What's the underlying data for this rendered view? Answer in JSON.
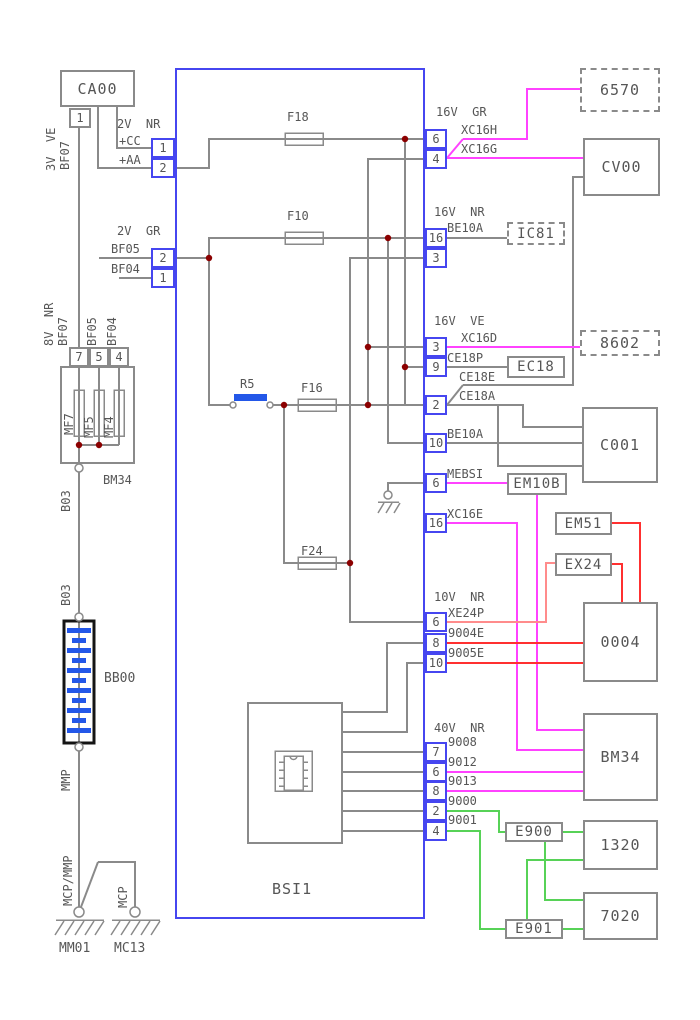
{
  "unit": {
    "name": "BSI1"
  },
  "components": {
    "ca00": "CA00",
    "fusebox": "BM34",
    "battery": "BB00",
    "ground_left": "MM01",
    "ground_right": "MC13",
    "b6570": "6570",
    "cv00": "CV00",
    "ic81": "IC81",
    "b8602": "8602",
    "ec18": "EC18",
    "c001": "C001",
    "em10b": "EM10B",
    "em51": "EM51",
    "ex24": "EX24",
    "b0004": "0004",
    "bm34": "BM34",
    "e900": "E900",
    "b1320": "1320",
    "e901": "E901",
    "b7020": "7020"
  },
  "fuses": {
    "f18": "F18",
    "f10": "F10",
    "f16": "F16",
    "f24": "F24",
    "mf7": "MF7",
    "mf5": "MF5",
    "mf4": "MF4",
    "r5": "R5"
  },
  "wires": {
    "v3ve": "3V  VE",
    "bf07_top": "BF07",
    "v2nr": "2V  NR",
    "cc": "+CC",
    "aa": "+AA",
    "v2gr": "2V  GR",
    "bf05": "BF05",
    "bf04": "BF04",
    "v8nr": "8V  NR",
    "bf07": "BF07",
    "bf05v": "BF05",
    "bf04v": "BF04",
    "b03_a": "B03",
    "b03_b": "B03",
    "mmp": "MMP",
    "mcp_mmp": "MCP/MMP",
    "mcp": "MCP",
    "g16vgr": "16V  GR",
    "xc16h": "XC16H",
    "xc16g": "XC16G",
    "g16vnr": "16V  NR",
    "be10a_a": "BE10A",
    "g16vve": "16V  VE",
    "xc16d": "XC16D",
    "ce18p": "CE18P",
    "ce18e": "CE18E",
    "ce18a": "CE18A",
    "be10a_b": "BE10A",
    "mebsi": "MEBSI",
    "xc16e": "XC16E",
    "g10vnr": "10V  NR",
    "xe24p": "XE24P",
    "n9004e": "9004E",
    "n9005e": "9005E",
    "g40vnr": "40V  NR",
    "n9008": "9008",
    "n9012": "9012",
    "n9013": "9013",
    "n9000": "9000",
    "n9001": "9001"
  },
  "pins": {
    "ca1": "1",
    "l1": "1",
    "l2": "2",
    "l3": "2",
    "l4": "1",
    "mf7": "7",
    "mf5": "5",
    "mf4": "4",
    "r1": "6",
    "r2": "4",
    "r3": "16",
    "r4": "3",
    "r5": "3",
    "r6": "9",
    "r7": "2",
    "r8": "10",
    "r9": "6",
    "r10": "16",
    "r11": "6",
    "r12": "8",
    "r13": "10",
    "r14": "7",
    "r15": "6",
    "r16": "8",
    "r17": "2",
    "r18": "4"
  },
  "colors": {
    "wire_gray": "#8a8a8a",
    "wire_magenta": "#ff42ff",
    "wire_red": "#ff3030",
    "wire_salmon": "#ff8c8c",
    "wire_green": "#57d257",
    "accent_blue": "#2357e8",
    "box_blue": "#4646f0",
    "junction": "#8b0000",
    "text": "#565656"
  }
}
